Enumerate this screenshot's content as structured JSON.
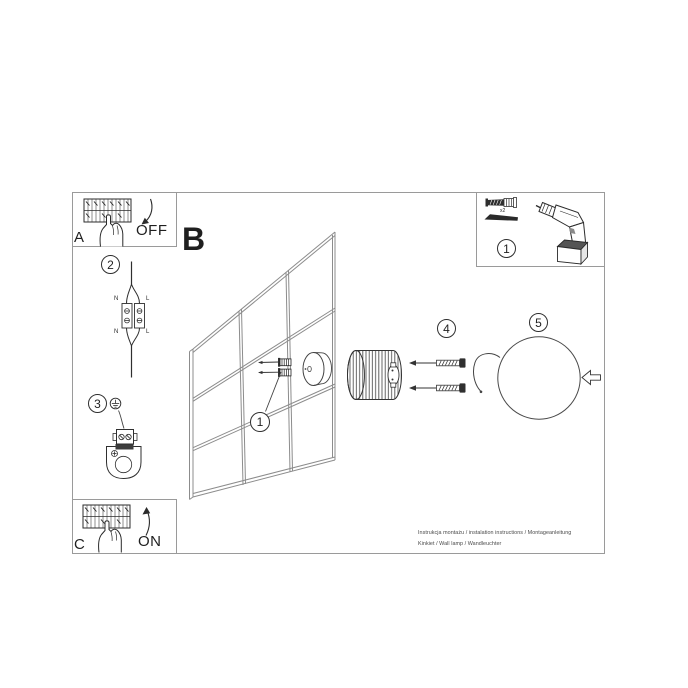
{
  "sheet": {
    "steps": {
      "a": {
        "letter": "A",
        "action": "OFF"
      },
      "b": {
        "letter": "B"
      },
      "c": {
        "letter": "C",
        "action": "ON"
      }
    },
    "callouts": {
      "connector": "2",
      "bracket": "3",
      "base": "1",
      "screws": "4",
      "diffuser": "5",
      "tools": "1"
    },
    "connector_terminals": {
      "n_top": "N",
      "l_top": "L",
      "n_bottom": "N",
      "l_bottom": "L"
    },
    "tools": {
      "qty": "x2"
    },
    "footer": {
      "line1": "Instrukcja montażu / instalation instructions / Montageanleitung",
      "line2": "Kinkiet / Wall lamp / Wandleuchter"
    },
    "icons": [
      "breaker-panel-icon",
      "hand-icon",
      "off-arrow-icon",
      "on-arrow-icon",
      "wire-connector-icon",
      "earth-symbol-icon",
      "mounting-bracket-icon",
      "wall-grid",
      "wall-plug-icon",
      "screw-icon",
      "base-ring-icon",
      "shade-icon",
      "hook-icon",
      "diffuser-sphere",
      "push-arrow-icon",
      "anchor-screw-icon",
      "drill-bit-icon",
      "drill-icon"
    ]
  }
}
